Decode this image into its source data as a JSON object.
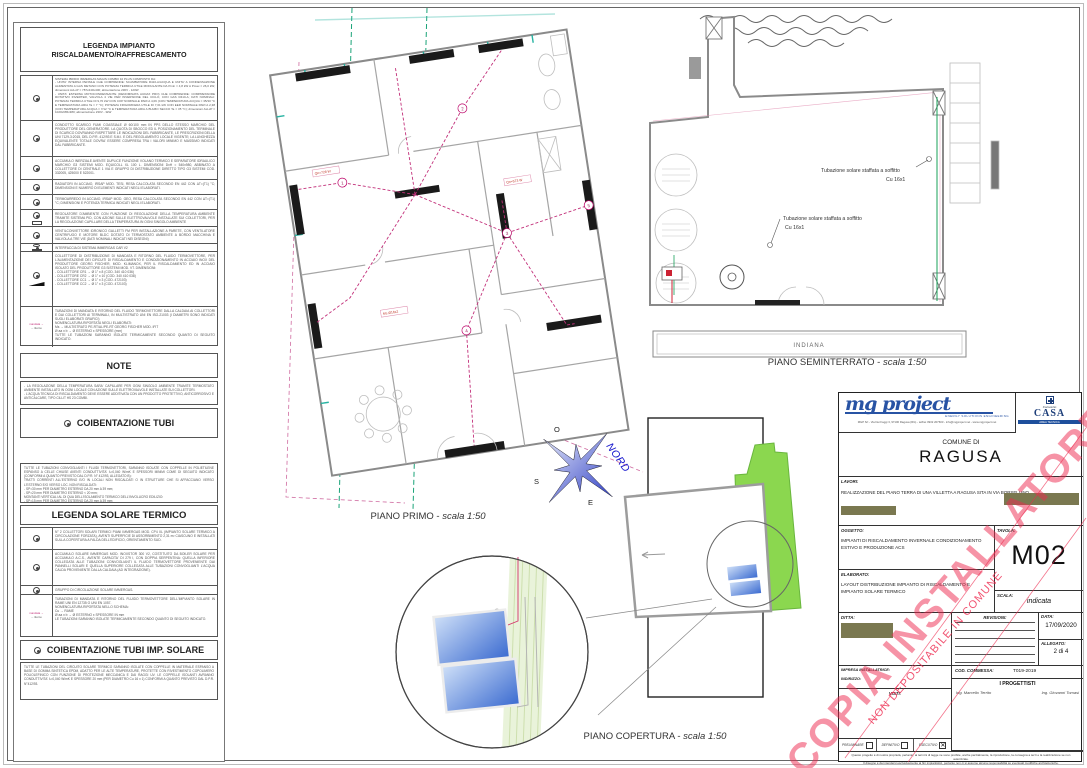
{
  "legend_heating": {
    "title": "LEGENDA IMPIANTO RISCALDAMENTO/RAFFRESCAMENTO",
    "flow_supply": "mandata",
    "flow_return": "ritorno",
    "items": [
      {
        "text": "SISTEMA IBRIDO IMMERGAS MAGIS COMBO 10 PLUS COMPOSTO DA:\n- UNITA' INTERNA PENSILE CHE COMPRENDE: SCAMBIATORE R410-A/ACQUA E UNITA' A CONDENSAZIONE ALIMENTATA A GAS METANO CON POTENZA TERMICA UTILE MODULANTE DA Pmin = 4,8 kW A Pmax = 26,0 kW; dimensioni AxLxP = 787x440x400; alimentazione 230V - 120W\n- UNITA' ESTERNA MOTOCONDENSANTE (DENOMINATA AUDAX PRO) CHE COMPRENDE: COMPRESSORE ROTATIVO INVERTER, VALVOLA 4 VIE PER INVERSIONE DEL CICLO, CON GAS R410-A; DATI NOMINALI: POTENZA TERMICA UTILE DI 9,70 kW CON COP NOMINALE PARI A 4,09 (CON TEMPERATURA ACQUA = 35/30 °C E TEMPERATURA ARIA Ta = 7 °C); POTENZA FRIGORIFERA UTILE DI 7,01 kW CON EER NOMINALE PARI A 2,38 (CON TEMPERATURA ACQUA = 7/12 °C E TEMPERATURA ARIA A BULBO SECCO Ta = 35 °C); dimensioni AxLxP = 1020x965x380; alimentazione 230V - 3kW"
      },
      {
        "text": "CONDOTTO SCARICO FUMI COASSIALE Ø 60/100 mm IN PPS DELLO STESSO MARCHIO DEL PRODUTTORE DEL GENERATORE. LA QUOTA DI SBOCCO ED IL POSIZIONAMENTO DEL TERMINALE DI SCARICO DOVRANNO RISPETTARE LE INDICAZIONI DEL FABBRICANTE, LE PRESCRIZIONI DELLA UNI 7129-3:2015, DEL D.P.R. 412/93 E S.M.I. E DEL REGOLAMENTO LOCALE VIGENTE; LA LUNGHEZZA EQUIVALENTE TOTALE DOVRA' ESSERE COMPRESA TRA I VALORI MINIMO E MASSIMO INDICATI DAL FABBRICANTE."
      },
      {
        "text": "ACCUMULO INERZIALE AVENTE DUPLICE FUNZIONE VOLANO TERMICO E SEPARATORE IDRAULICO MARCHIO G3 SISTEMI MOD. EQUICOLL XL 100 L. DIMENSIONI DxH = 540x980, ABBINATO A COLLETTORE DI CENTRALE 1 VIA E GRUPPO DI DISTRIBUZIONE DIRETTO TIPO G3 SISTEMI COD. 332005, 425000 E 522001."
      },
      {
        "text": "RADIATORI IN ACCIAIO, IRSAP MOD. TESI, RESA CALCOLATA SECONDO EN 442 CON ΔT=(T1) °C; DIMENSIONI E NUMERO DI ELEMENTI INDICATI NEGLI ELABORATI."
      },
      {
        "text": "TERMOARREDO IN ACCIAIO, IRSAP MOD. GEO, RESA CALCOLATA SECONDO EN 442 CON ΔT=(T1) °C; DIMENSIONI E POTENZA TERMICA INDICATI NEGLI ELABORATI."
      },
      {
        "text": "REGOLATORE D'AMBIENTE CON FUNZIONE DI REGOLAZIONE DELLA TEMPERATURA AMBIENTE TRAMITE SISTEMA PID, CON AZIONE SULLE ELETTROVALVOLE INSTALLATE SUI COLLETTORI, PER LA REGOLAZIONE CAPILLARE DELLA TEMPERATURA IN OGNI SINGOLO AMBIENTE"
      },
      {
        "text": "VENTILCONVETTORE IDRONICO GALLETTI FM PER INSTALLAZIONE A PARETE, CON VENTILATORE CENTRIFUGO E MOTORE BLDC DOTATO DI TERMOSTATO AMBIENTE A BORDO MACCHINA E VALVOLA A TRE VIE (DATI NOMINALI INDICATI NEI DISEGNI)"
      },
      {
        "text": "INTERFACCIA DI SISTEMA IMMERGAS CAR V2"
      },
      {
        "text": "COLLETTORE DI DISTRIBUZIONE DI MANDATA E RITORNO DEL FLUIDO TERMOVETTORE, PER L'ALIMENTAZIONE DEI CIRCUITI DI RISCALDAMENTO E CONDIZIONAMENTO IN ACCIAIO INOX DEL PRODUTTORE GEORG FISCHER, MOD. KLIMANOX, PER IL RISCALDAMENTO ED IN ACCIAIO ISOLATO DEL PRODUTTORE G3 SISTEMI MOD. VT. DIMENSIONI:\n- COLLETTORE CR1 → Ø 1\" x 8 (COD. 340 410 036)\n- COLLETTORE CR2 → Ø 1\" x 10 (COD. 340 410 038)\n- COLLETTORE CC1 → Ø 1\" x 3 (COD. 472103)\n- COLLETTORE CC2 → Ø 1\" x 3 (COD. 472103)"
      },
      {
        "text": "TUBAZIONI DI MANDATA E RITORNO DEL FLUIDO TERMOVETTORE DALLA CALDAIA AI COLLETTORI E DAI COLLETTORI AI TERMINALI, IN MULTISTRATO UNI EN ISO-21003 (I DIAMETRI SONO INDICATI SUGLI ELABORATI GRAFICI)\nNOMENCLATURA RIPORTATA NEGLI ELABORATI:\nMs → MULTISTRATO PE-RT/AL/PE-RT GEORG FISCHER MOD. iFIT\nØ aa x b → Ø ESTERNO x SPESSORE (mm)\nTUTTE LE TUBAZIONI SARANNO ISOLATE TERMICAMENTE SECONDO QUANTO DI SEGUITO INDICATO."
      }
    ]
  },
  "notes": {
    "title": "NOTE",
    "text": "- LA REGOLAZIONE DELLA TEMPERATURA SARA' CAPILLARE PER OGNI SINGOLO AMBIENTE TRAMITE TERMOSTATO AMBIENTE INSTALLATO IN OGNI LOCALE CON AZIONE SULLE ELETTROVALVOLE INSTALLATE SUI COLLETTORI.\n- L'ACQUA TECNICA DI RISCALDAMENTO DEVE ESSERE ADDITIVATA CON UN PRODOTTO PROTETTIVO, ANTICORROSIVO E ANTICALCARE, TIPO CILLIT HS 23 COMBI."
  },
  "coibentazione": {
    "title": "COIBENTAZIONE TUBI",
    "text": "TUTTE LE TUBAZIONI CONVOGLIANTI I FLUIDI TERMOVETTORI, SARANNO ISOLATE CON COPPELLE IN POLIETILENE ESPANSO A CELLE CHIUSE AVENTI CONDUTTIVITA' λ=0,040 W/mK E SPESSORI MINIMI COME DI SEGUITO INDICATO (CONFORMI A QUANTO PREVISTO DAL D.P.R. N° 412/93, ALLEGATO B):\nTRATTI CORRENTI ALL'ESTERNO E/O IN LOCALI NON RISCALDATI O IN STRUTTURE CHE SI AFFACCIANO VERSO L'ESTERNO E/O VERSO LOC. NON RISCALDATI:\n- SP=30 mm PER DIAMETRO ESTERNO DA 20 mm A 39 mm;\n- SP=20 mm PER DIAMETRO ESTERNO < 20 mm;\nMONTANTI VERTICALI AL DI QUA DELL'ISOLAMENTO TERMICO DELL'INVOLUCRO EDILIZIO:\n- SP=15 mm PER DIAMETRO ESTERNO DA 20 mm A 39 mm;\n- SP=10 mm PER DIAMETRO ESTERNO < 20 mm;\nTRATTI ORIZZONTALI CORRENTI ALL'INTERNO DEI LOCALI RISCALDATI E IN STRUTTURE CHE NON SI AFFACCIANO VERSO L'ESTERNO E/O VERSO LOC. NON RISCALDATI:\n- SP=9 mm PER DIAMETRO ESTERNO DA 20 mm A 39 mm;\n- SP=6 mm PER DIAMETRO ESTERNO < 20 mm."
  },
  "legend_solar": {
    "title": "LEGENDA SOLARE TERMICO",
    "items": [
      {
        "text": "N° 2 COLLETTORI SOLARI TERMICI PIANI IMMERGAS MOD. CP4 XL (IMPIANTO SOLARE TERMICO A CIRCOLAZIONE FORZATA), AVENTI SUPERFICIE DI ASSORBIMENTO 2,31 m² CIASCUNO E INSTALLATI SULLA COPERTURA A FALDA DELL'EDIFICIO, ORIENTAMENTO SUD."
      },
      {
        "text": "ACCUMULO SOLARE IMMERGAS MOD. INOXSTOR 300 V2, COSTITUITO DA BOILER SOLARE PER ACCUMULO A.C.S., AVENTE CAPACITA' DI 279 l, CON DOPPIA SERPENTINA: QUELLA INFERIORE COLLEGATA ALLE TUBAZIONI CONVOGLIANTI IL FLUIDO TERMOVETTORE PROVENIENTE DAI PANNELLI SOLARI E QUELLA SUPERIORE COLLEGATA ALLE TUBAZIONI CONVOGLIANTI L'ACQUA CALDA PROVENIENTE DALLA CALDAIA (AD INTEGRAZIONE)."
      },
      {
        "text": "GRUPPO DI CIRCOLAZIONE SOLARE IMMERGAS."
      },
      {
        "text": "TUBAZIONI DI MANDATA E RITORNO DEL FLUIDO TERMOVETTORE DELL'IMPIANTO SOLARE IN RAME UNI EN 12735 O UNI EN 1057.\nNOMENCLATURA RIPORTATA NELLO SCHEMA:\nCu → RAME\nØ aa x b → Ø ESTERNO x SPESSORE IN mm\nLE TUBAZIONI SARANNO ISOLATE TERMICAMENTE SECONDO QUANTO DI SEGUITO INDICATO."
      }
    ]
  },
  "coibentazione_solare": {
    "title": "COIBENTAZIONE TUBI IMP. SOLARE",
    "text": "TUTTE LE TUBAZIONI DEL CIRCUITO SOLARE TERMICO SARANNO ISOLATE CON COPPELLE IN MATERIALE ESPANSO A BASE DI GOMMA SINTETICA EPDM, ADATTO PER LE ALTE TEMPERATURE, PROTETTE CON RIVESTIMENTO COPOLIMERO POLIOLEFINICO CON FUNZIONE DI PROTEZIONE MECCANICA E DAI RAGGI UV. LE COPPELLE ISOLANTI AVRANNO CONDUTTIVITA' λ=0,040 W/mK E SPESSORE 20 mm (PER DIAMETRO Cu 16 x 1) CONFORMI A QUANTO PREVISTO DAL D.P.R. N°412/93."
  },
  "plans": {
    "piano_primo": {
      "caption_name": "PIANO PRIMO -",
      "caption_scale": "scala 1:50",
      "nodes": [
        "1",
        "2",
        "3",
        "4",
        "5"
      ],
      "labels": {
        "q1": "Qn=728 W",
        "q2": "Qn=573 W",
        "p1": "Ms Ø16x2"
      }
    },
    "piano_seminterrato": {
      "caption_name": "PIANO SEMINTERRATO -",
      "caption_scale": "scala 1:50",
      "area_label": "INDIANA",
      "leader_text": "Tubazione solare staffata a soffitto",
      "leader_size": "Cu 16x1"
    },
    "piano_copertura": {
      "caption_name": "PIANO COPERTURA -",
      "caption_scale": "scala 1:50"
    },
    "compass": {
      "n": "NORD",
      "o": "O",
      "s": "S",
      "e": "E"
    }
  },
  "title_block": {
    "logo": {
      "name": "mg project",
      "tagline": "ENERGY SOLUTIONS ENGINEERING",
      "address": "MGP Srl - Via Dei Faggi 3, 97100 Ragusa (RG) - tel/fax 0932 207603 - info@mgproject.net - www.mgproject.net",
      "partner_top": "Consorzio",
      "partner_name": "CASA",
      "partner_sub": "AREA TECNICA"
    },
    "comune_label": "COMUNE DI",
    "comune": "RAGUSA",
    "lavori_label": "LAVORI:",
    "lavori": "REALIZZAZIONE DEL PIANO TERRA DI UNA VILLETTA A RAGUSA SITA IN VIA BORSELLINO",
    "oggetto_label": "OGGETTO:",
    "oggetto": "IMPIANTI DI RISCALDAMENTO INVERNALE CONDIZIONAMENTO ESTIVO E PRODUZIONE ACS",
    "elaborato_label": "ELABORATO:",
    "elaborato": "LAYOUT DISTRIBUZIONE IMPIANTO DI RISCALDAMENTO E IMPIANTO SOLARE TERMICO",
    "tavola_label": "TAVOLA:",
    "tavola": "M02",
    "scala_label": "SCALA:",
    "scala": "indicata",
    "ditta_label": "DITTA:",
    "revisioni_label": "REVISIONI:",
    "data_label": "DATA:",
    "data": "17/09/2020",
    "allegato_label": "ALLEGATO:",
    "allegato": "2 di 4",
    "impresa_label": "IMPRESA INSTALLATRICE:",
    "indirizzo_label": "INDIRIZZO:",
    "visti_label": "VISTI:",
    "commessa_label": "COD. COMMESSA:",
    "commessa": "T019-2019",
    "progettisti_label": "I PROGETTISTI",
    "progettista_1": "Ing. Marcello Territo",
    "progettista_2": "Ing. Giovanni Tomasi",
    "checkboxes": [
      {
        "label": "PRELIMINARE",
        "mark": ""
      },
      {
        "label": "DEFINITIVO",
        "mark": ""
      },
      {
        "label": "ESECUTIVO",
        "mark": "✕"
      }
    ],
    "disclaimer": "Questo progetto è di nostra proprietà, pertanto, ai termini di legge ne sono proibite, anche parzialmente, la riproduzione, la consegna a terzi e la realizzazione se non autorizzate.\nIl disegno è da intendersi esclusivamente ai fini impiantistici, pertanto non ci si assume alcuna responsabilità su eventuali modifiche architettoniche."
  },
  "watermark": {
    "line1": "COPIA INSTALLATORE",
    "line2": "NON DEPOSITABILE IN COMUNE",
    "color": "#ee2a4f"
  },
  "colors": {
    "pipe_red": "#c2307a",
    "solar_green": "#18a05a",
    "roof_green": "#8bd74f",
    "panel_blue": "#3a6ad0",
    "redaction_olive": "#7a7850",
    "logo_blue": "#2853a4"
  }
}
